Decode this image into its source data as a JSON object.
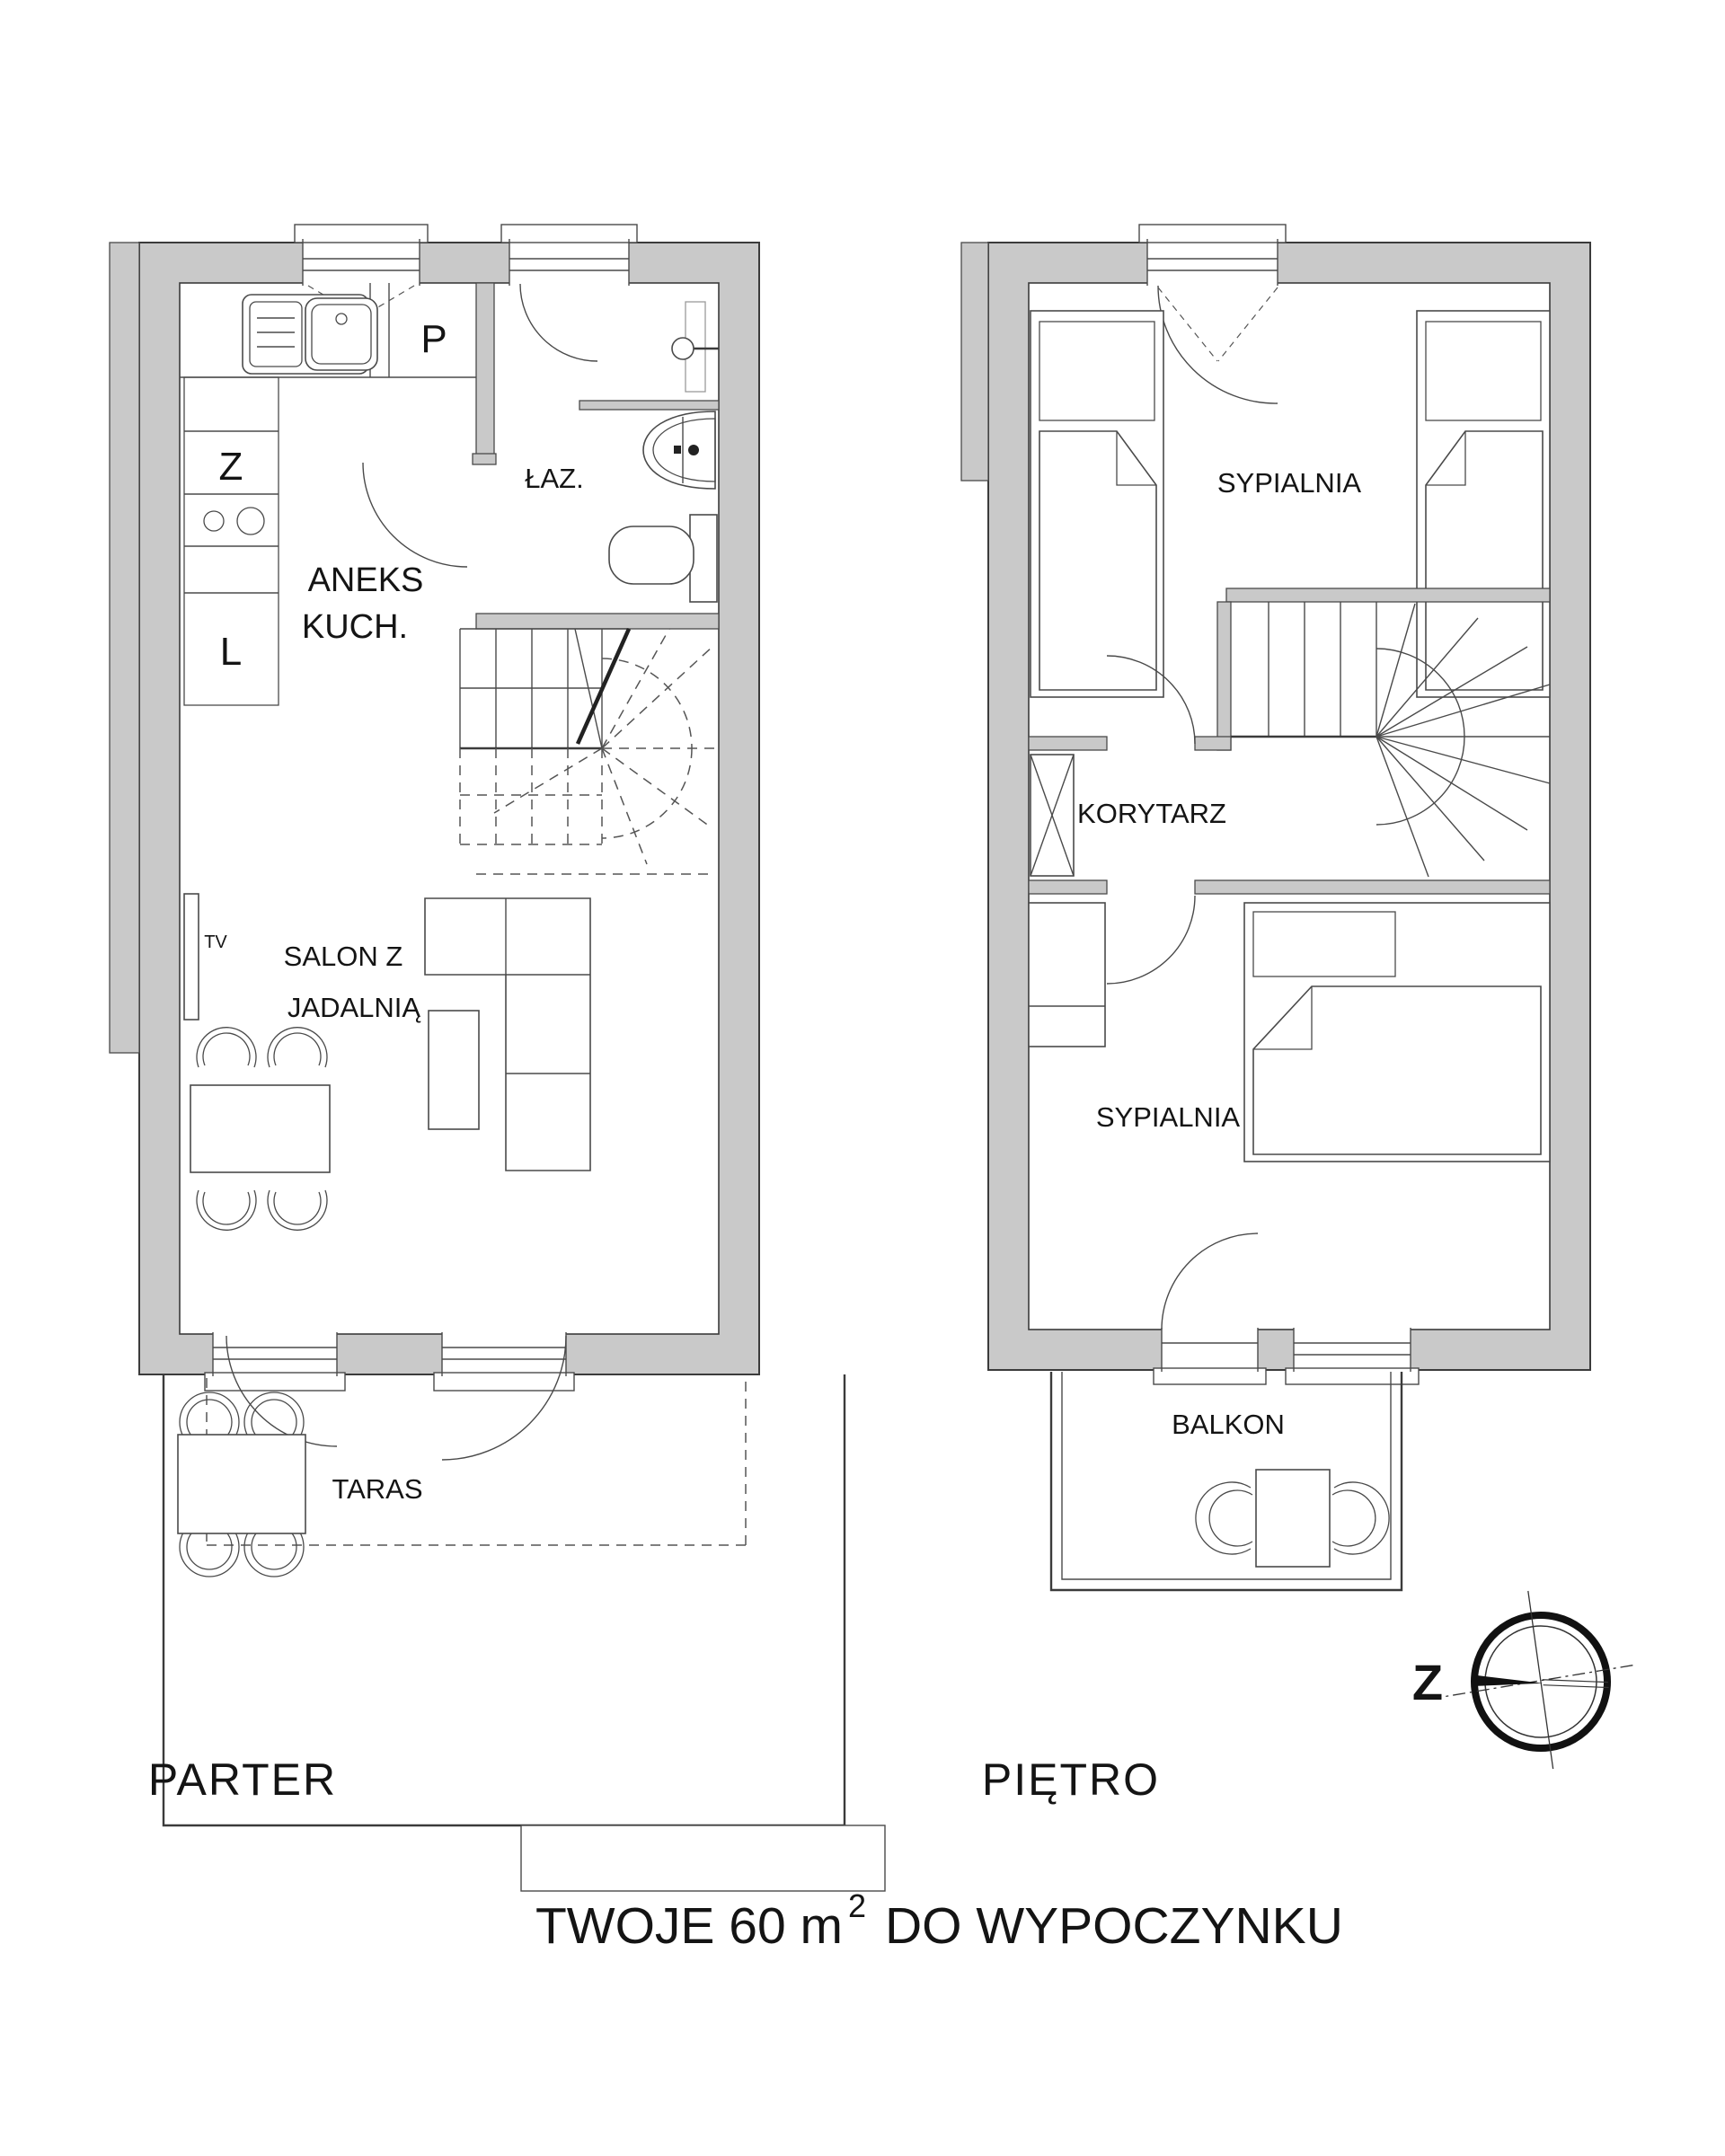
{
  "title": {
    "prefix": "TWOJE 60 m",
    "superscript": "2",
    "suffix": "DO WYPOCZYNKU"
  },
  "parter": {
    "label": "PARTER",
    "rooms": {
      "kitchen": {
        "line1": "ANEKS",
        "line2": "KUCH."
      },
      "bathroom": {
        "label": "ŁAZ."
      },
      "living": {
        "line1": "SALON Z",
        "line2": "JADALNIĄ"
      },
      "terrace": {
        "label": "TARAS"
      }
    },
    "appliances": {
      "p": "P",
      "z": "Z",
      "l": "L",
      "tv": "TV"
    }
  },
  "pietro": {
    "label": "PIĘTRO",
    "rooms": {
      "bedroom1": {
        "label": "SYPIALNIA"
      },
      "corridor": {
        "label": "KORYTARZ"
      },
      "bedroom2": {
        "label": "SYPIALNIA"
      },
      "balcony": {
        "label": "BALKON"
      }
    }
  },
  "compass": {
    "direction_label": "Z"
  },
  "icons": {
    "compass": "compass-rose-icon",
    "kitchen_sink": "kitchen-sink-icon",
    "stove": "stove-burners-icon",
    "washbasin": "washbasin-icon",
    "toilet": "toilet-icon",
    "shower": "shower-head-icon"
  },
  "colors": {
    "wall_fill": "#c9c9c9",
    "line": "#3b3b3b",
    "background": "#ffffff"
  }
}
